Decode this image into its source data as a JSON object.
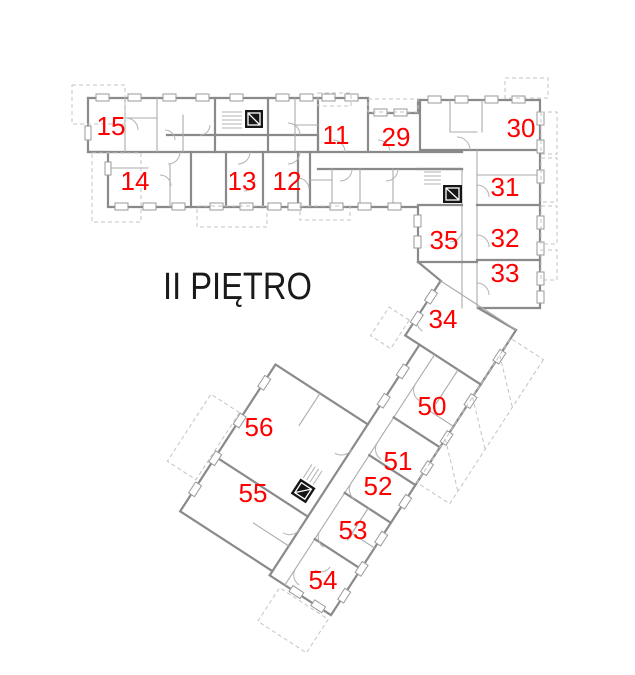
{
  "title": "II PIĘTRO",
  "rooms": {
    "r15": "15",
    "r14": "14",
    "r13": "13",
    "r12": "12",
    "r11": "11",
    "r29": "29",
    "r30": "30",
    "r31": "31",
    "r32": "32",
    "r33": "33",
    "r34": "34",
    "r35": "35",
    "r50": "50",
    "r51": "51",
    "r52": "52",
    "r53": "53",
    "r54": "54",
    "r55": "55",
    "r56": "56"
  },
  "colors": {
    "room_number": "#ff0000",
    "title_text": "#1a1a1a",
    "walls": "#8a8a8a",
    "background": "#ffffff"
  }
}
